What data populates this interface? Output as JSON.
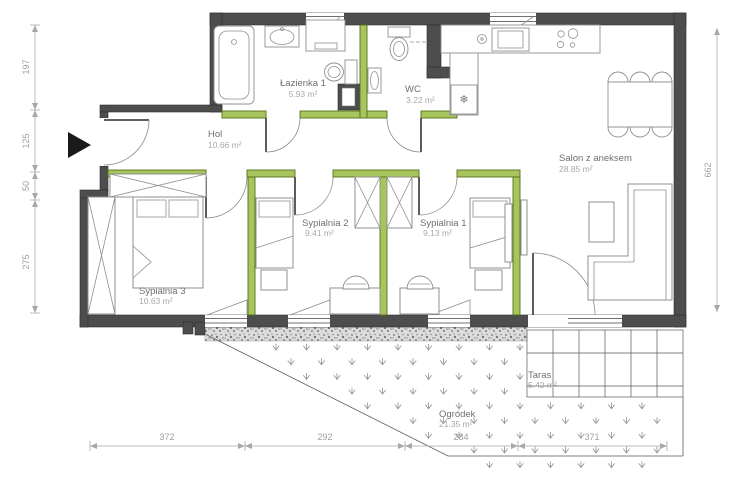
{
  "plan": {
    "rooms": [
      {
        "id": "lazienka1",
        "name": "Łazienka 1",
        "area": "5.93 m²"
      },
      {
        "id": "wc",
        "name": "WC",
        "area": "3.22 m²"
      },
      {
        "id": "hol",
        "name": "Hol",
        "area": "10.66 m²"
      },
      {
        "id": "salon",
        "name": "Salon z aneksem",
        "area": "28.85 m²"
      },
      {
        "id": "sypialnia2",
        "name": "Sypialnia 2",
        "area": "9.41 m²"
      },
      {
        "id": "sypialnia1",
        "name": "Sypialnia 1",
        "area": "9.13 m²"
      },
      {
        "id": "sypialnia3",
        "name": "Sypialnia 3",
        "area": "10.63 m²"
      },
      {
        "id": "taras",
        "name": "Taras",
        "area": "5.42 m²"
      },
      {
        "id": "ogrodek",
        "name": "Ogródek",
        "area": "21.35 m²"
      }
    ],
    "dimensions": {
      "left": [
        "197",
        "125",
        "50",
        "275"
      ],
      "right": [
        "662"
      ],
      "bottom": [
        "372",
        "292",
        "284",
        "371"
      ]
    },
    "icons": {
      "fridge": "❄"
    },
    "colors": {
      "wall": "#4d4d4d",
      "partition": "#a8c45c",
      "partition_stroke": "#567119",
      "dimension": "#9e9e9e",
      "entrance_arrow": "#1a1a1a"
    }
  }
}
